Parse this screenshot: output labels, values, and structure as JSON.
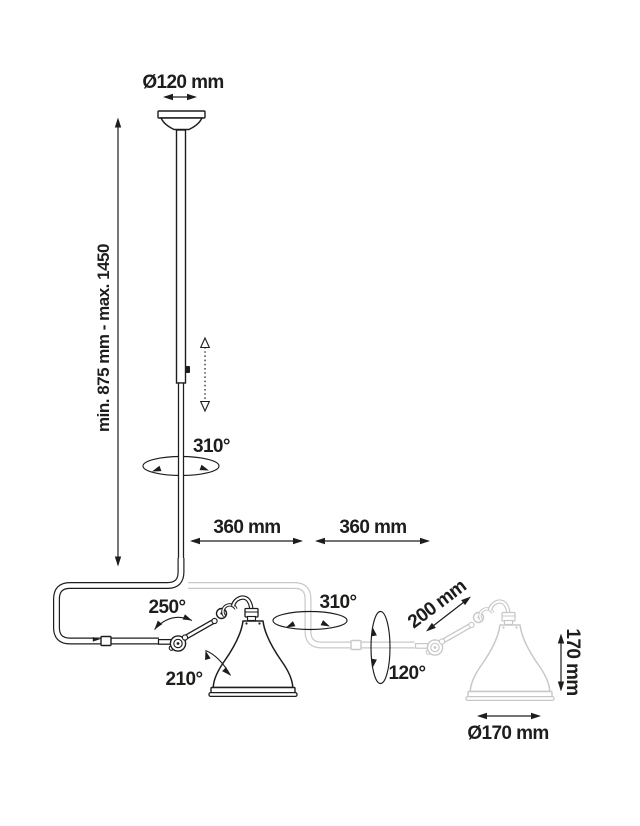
{
  "diagram": {
    "colors": {
      "ink": "#1d1d1b",
      "ghost": "#c8c8c8",
      "background": "#ffffff"
    }
  },
  "dimensions": {
    "canopy_diameter": "Ø120 mm",
    "drop_height_range": "min. 875 mm - max. 1450",
    "reach_left": "360 mm",
    "reach_right": "360 mm",
    "forearm_length": "200 mm",
    "shade_height": "170 mm",
    "shade_diameter": "Ø170 mm"
  },
  "angles": {
    "pole_rotation": "310°",
    "elbow_swivel": "250°",
    "shade_tilt": "210°",
    "arm_rotation": "310°",
    "head_rotation": "120°"
  }
}
